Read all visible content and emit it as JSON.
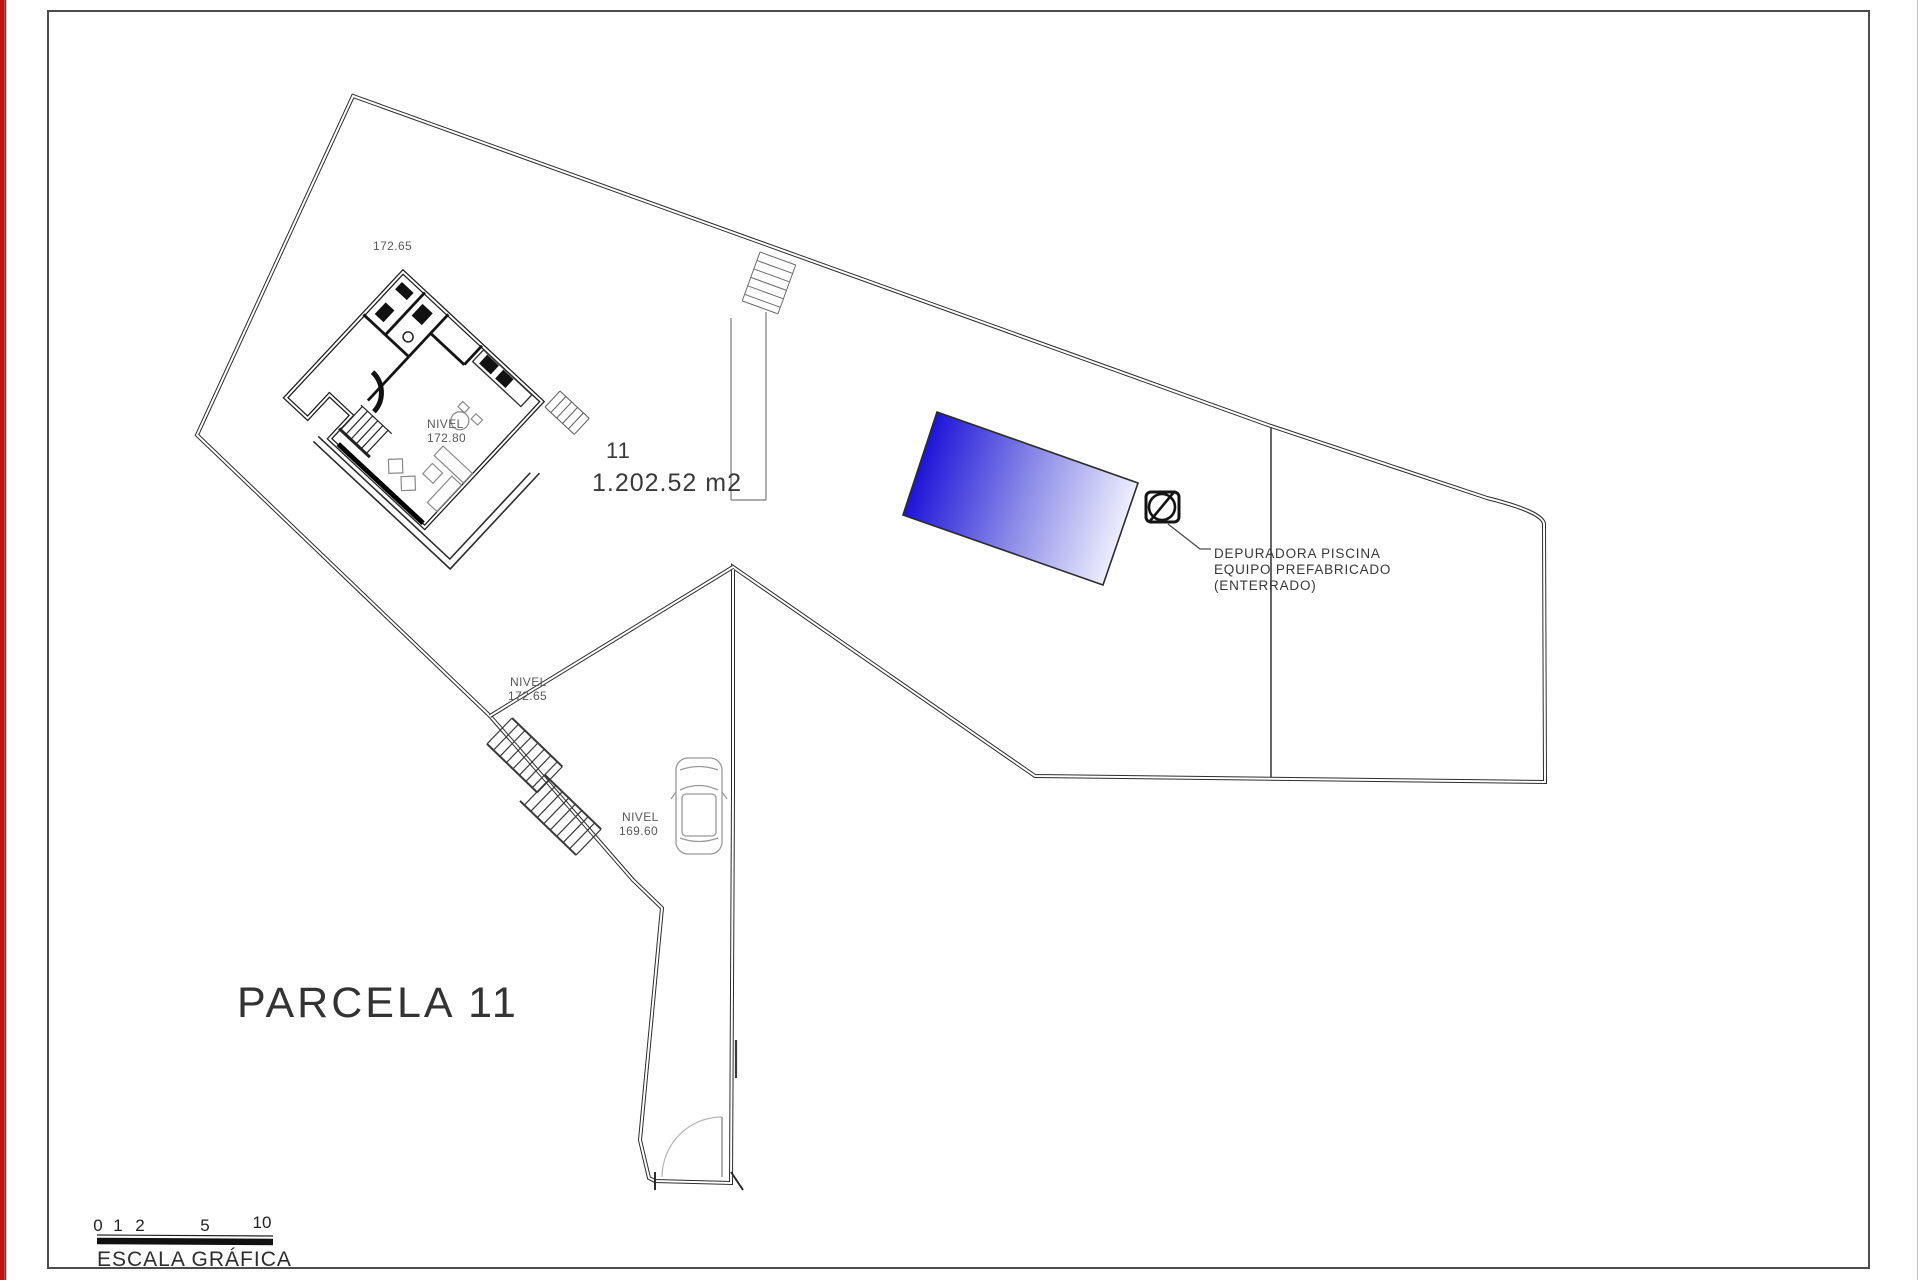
{
  "title": {
    "text": "PARCELA 11"
  },
  "plot": {
    "number": "11",
    "area": "1.202.52 m2"
  },
  "levels": {
    "spot_top": "172.65",
    "house": {
      "label": "NIVEL",
      "value": "172.80"
    },
    "terrace": {
      "label": "NIVEL",
      "value": "172.65"
    },
    "driveway": {
      "label": "NIVEL",
      "value": "169.60"
    }
  },
  "pool_note": {
    "line1": "DEPURADORA PISCINA",
    "line2": "EQUIPO PREFABRICADO",
    "line3": "(ENTERRADO)"
  },
  "scale_bar": {
    "ticks": [
      "0",
      "1",
      "2",
      "5",
      "10"
    ],
    "caption": "ESCALA GRÁFICA"
  },
  "colors": {
    "pool_deep": "#1a10d8",
    "pool_mid": "#8a8ae8",
    "pool_pale": "#f4f5fe",
    "line": "#333333",
    "red_edge": "#c11212"
  }
}
